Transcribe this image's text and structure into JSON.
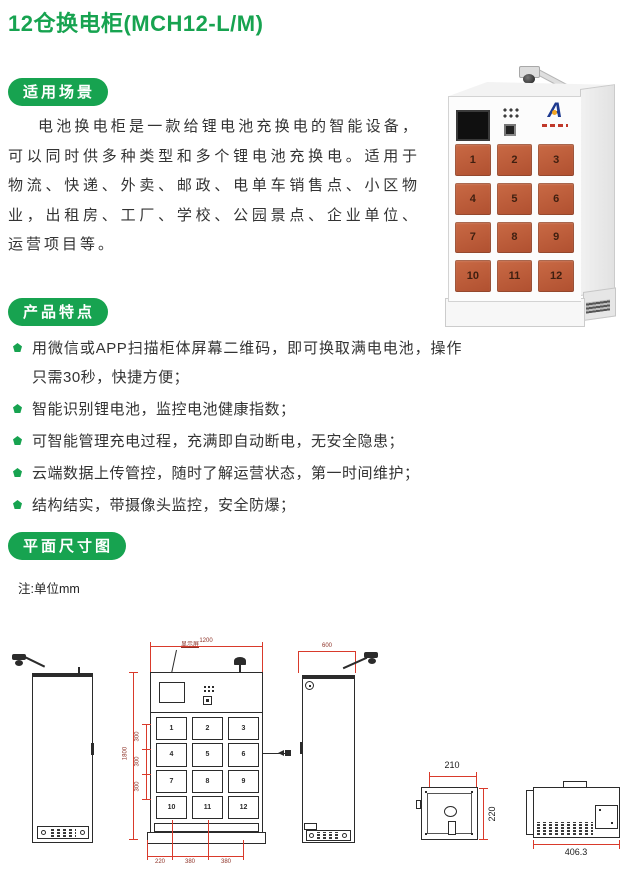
{
  "title": "12仓换电柜(MCH12-L/M)",
  "sections": {
    "scenarios": {
      "badge": "适用场景",
      "paragraph": "电池换电柜是一款给锂电池充换电的智能设备，可以同时供多种类型和多个锂电池充换电。适用于物流、快递、外卖、邮政、电单车销售点、小区物业，出租房、工厂、学校、公园景点、企业单位、运营项目等。"
    },
    "features": {
      "badge": "产品特点",
      "items": [
        "用微信或APP扫描柜体屏幕二维码，即可换取满电电池，操作只需30秒，快捷方便；",
        "智能识别锂电池，监控电池健康指数；",
        "可智能管理充电过程，充满即自动断电，无安全隐患；",
        "云端数据上传管控，随时了解运营状态，第一时间维护；",
        "结构结实，带摄像头监控，安全防爆；"
      ]
    },
    "plan": {
      "badge": "平面尺寸图",
      "note": "注:单位mm"
    }
  },
  "product": {
    "brand_mark": "A",
    "door_numbers": [
      "1",
      "2",
      "3",
      "4",
      "5",
      "6",
      "7",
      "8",
      "9",
      "10",
      "11",
      "12"
    ]
  },
  "drawings": {
    "front": {
      "screen_label": "显示屏",
      "top_width": "1200",
      "overall_height": "1800",
      "row_pitches": [
        "300",
        "300",
        "300"
      ],
      "bottom_segments": [
        "220",
        "380",
        "380"
      ]
    },
    "side_right": {
      "top_depth": "600"
    },
    "cell_front": {
      "width": "210",
      "height": "220"
    },
    "cell_side": {
      "depth": "406.3"
    }
  },
  "colors": {
    "accent_green": "#17a350",
    "dimension_red": "#d93a2b",
    "door_orange": "#c05b3b"
  }
}
